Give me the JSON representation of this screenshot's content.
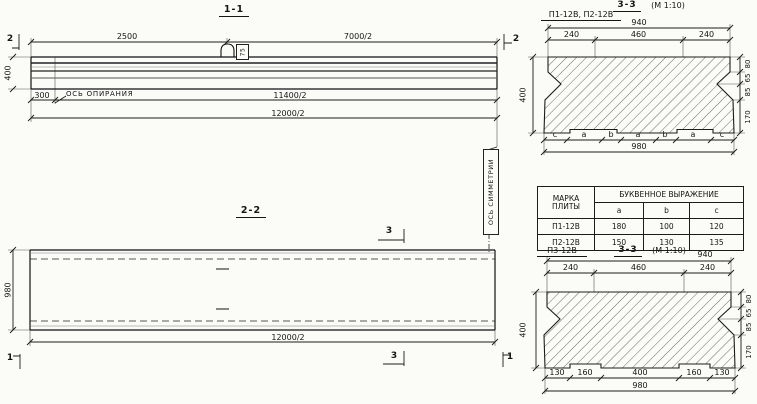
{
  "drawing": {
    "s11": {
      "title": "1-1",
      "dim_2500": "2500",
      "dim_7000": "7000/2",
      "cut_left": "2",
      "cut_right": "2",
      "dim_400": "400",
      "loop_tag": "75",
      "dim_300": "300",
      "support_axis_label": "ОСЬ ОПИРАНИЯ",
      "dim_11400": "11400/2",
      "dim_12000": "12000/2"
    },
    "symmetry_axis_label": "ОСЬ СИММЕТРИИ",
    "s22": {
      "title": "2-2",
      "cut3_top": "3",
      "cut3_bottom": "3",
      "cut1_left": "1",
      "cut1_right": "1",
      "dim_980": "980",
      "dim_12000": "12000/2"
    },
    "table": {
      "col_mark_line1": "МАРКА",
      "col_mark_line2": "ПЛИТЫ",
      "header_expr": "БУКВЕННОЕ ВЫРАЖЕНИЕ",
      "sub": [
        "a",
        "b",
        "c"
      ],
      "rows": [
        {
          "mark": "П1-12В",
          "a": "180",
          "b": "100",
          "c": "120"
        },
        {
          "mark": "П2-12В",
          "a": "150",
          "b": "130",
          "c": "135"
        }
      ]
    },
    "s33a": {
      "label": "П1-12В, П2-12В",
      "title": "3-3",
      "scale": "(М 1:10)",
      "dim_940": "940",
      "dims_top": [
        "240",
        "460",
        "240"
      ],
      "dim_400": "400",
      "dims_right": [
        "80",
        "65",
        "85",
        "170"
      ],
      "letters": [
        "c",
        "a",
        "b",
        "a",
        "b",
        "a",
        "c"
      ],
      "dim_980": "980"
    },
    "s33b": {
      "label": "П3-12В",
      "title": "3-3",
      "scale": "(М 1:10)",
      "dim_940": "940",
      "dims_top": [
        "240",
        "460",
        "240"
      ],
      "dim_400": "400",
      "dims_right": [
        "80",
        "65",
        "85",
        "170"
      ],
      "dims_bottom": [
        "130",
        "160",
        "400",
        "160",
        "130"
      ],
      "dim_980": "980"
    }
  }
}
